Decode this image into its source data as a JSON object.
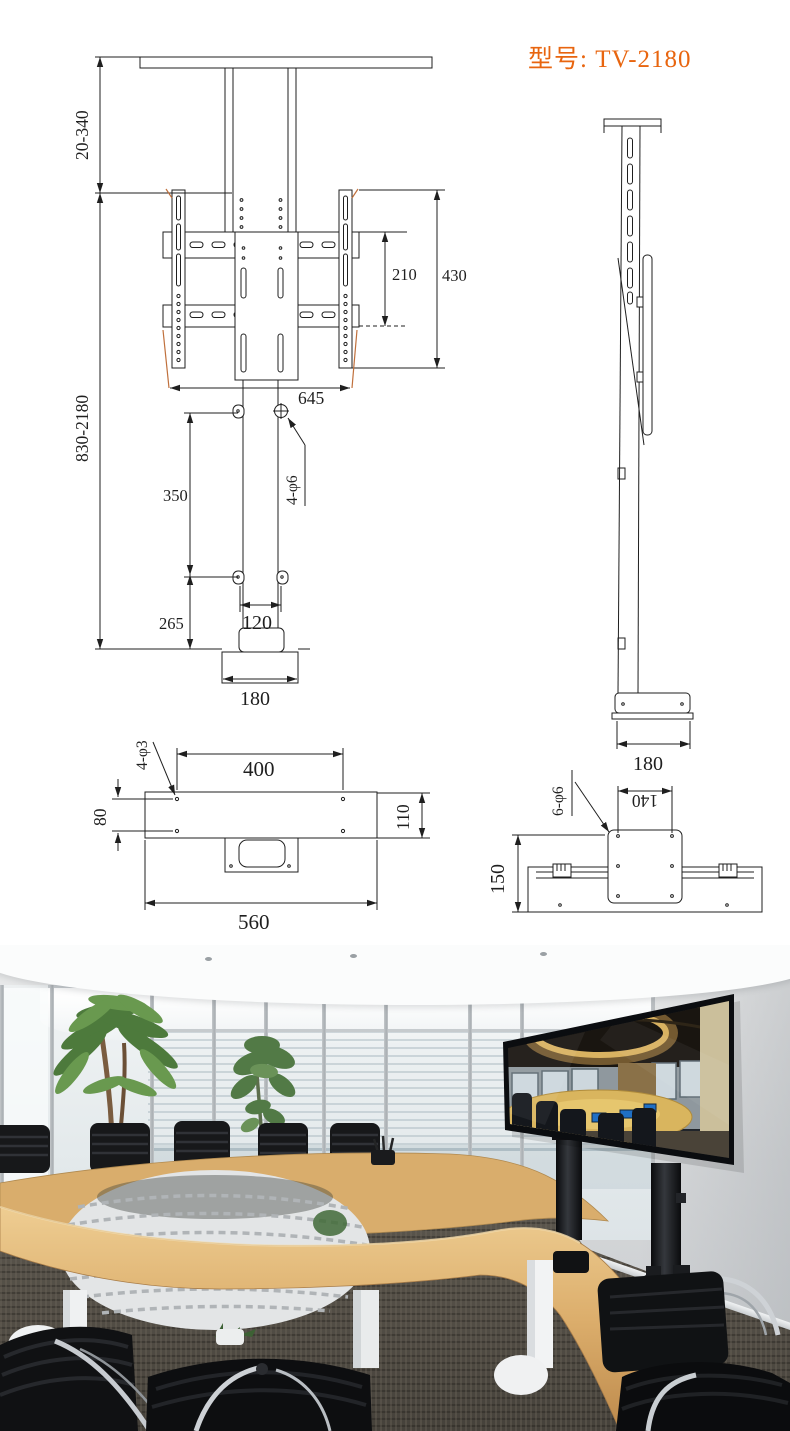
{
  "title": "型号: TV-2180",
  "colors": {
    "accent": "#e8650f",
    "drawing_line": "#1f1f1f",
    "extension_line": "#c0703c",
    "table_wood": "#d8ab6a",
    "stand_black": "#17181b"
  },
  "front_view": {
    "top_adjust_range": "20-340",
    "total_height_range": "830-2180",
    "vesa_vertical": "210",
    "bracket_height": "430",
    "bracket_width": "645",
    "upper_column_length": "350",
    "screw_callout": "4-φ6",
    "lower_column_length": "265",
    "column_width": "120",
    "base_width": "180"
  },
  "side_view": {
    "base_depth": "180"
  },
  "top_view": {
    "screw_callout": "4-φ3",
    "hole_span": "400",
    "hole_row_gap": "80",
    "bar_depth": "110",
    "bar_width": "560"
  },
  "bottom_view": {
    "plate_width": "140",
    "screw_callout": "6-φ6",
    "assembly_depth": "150"
  }
}
